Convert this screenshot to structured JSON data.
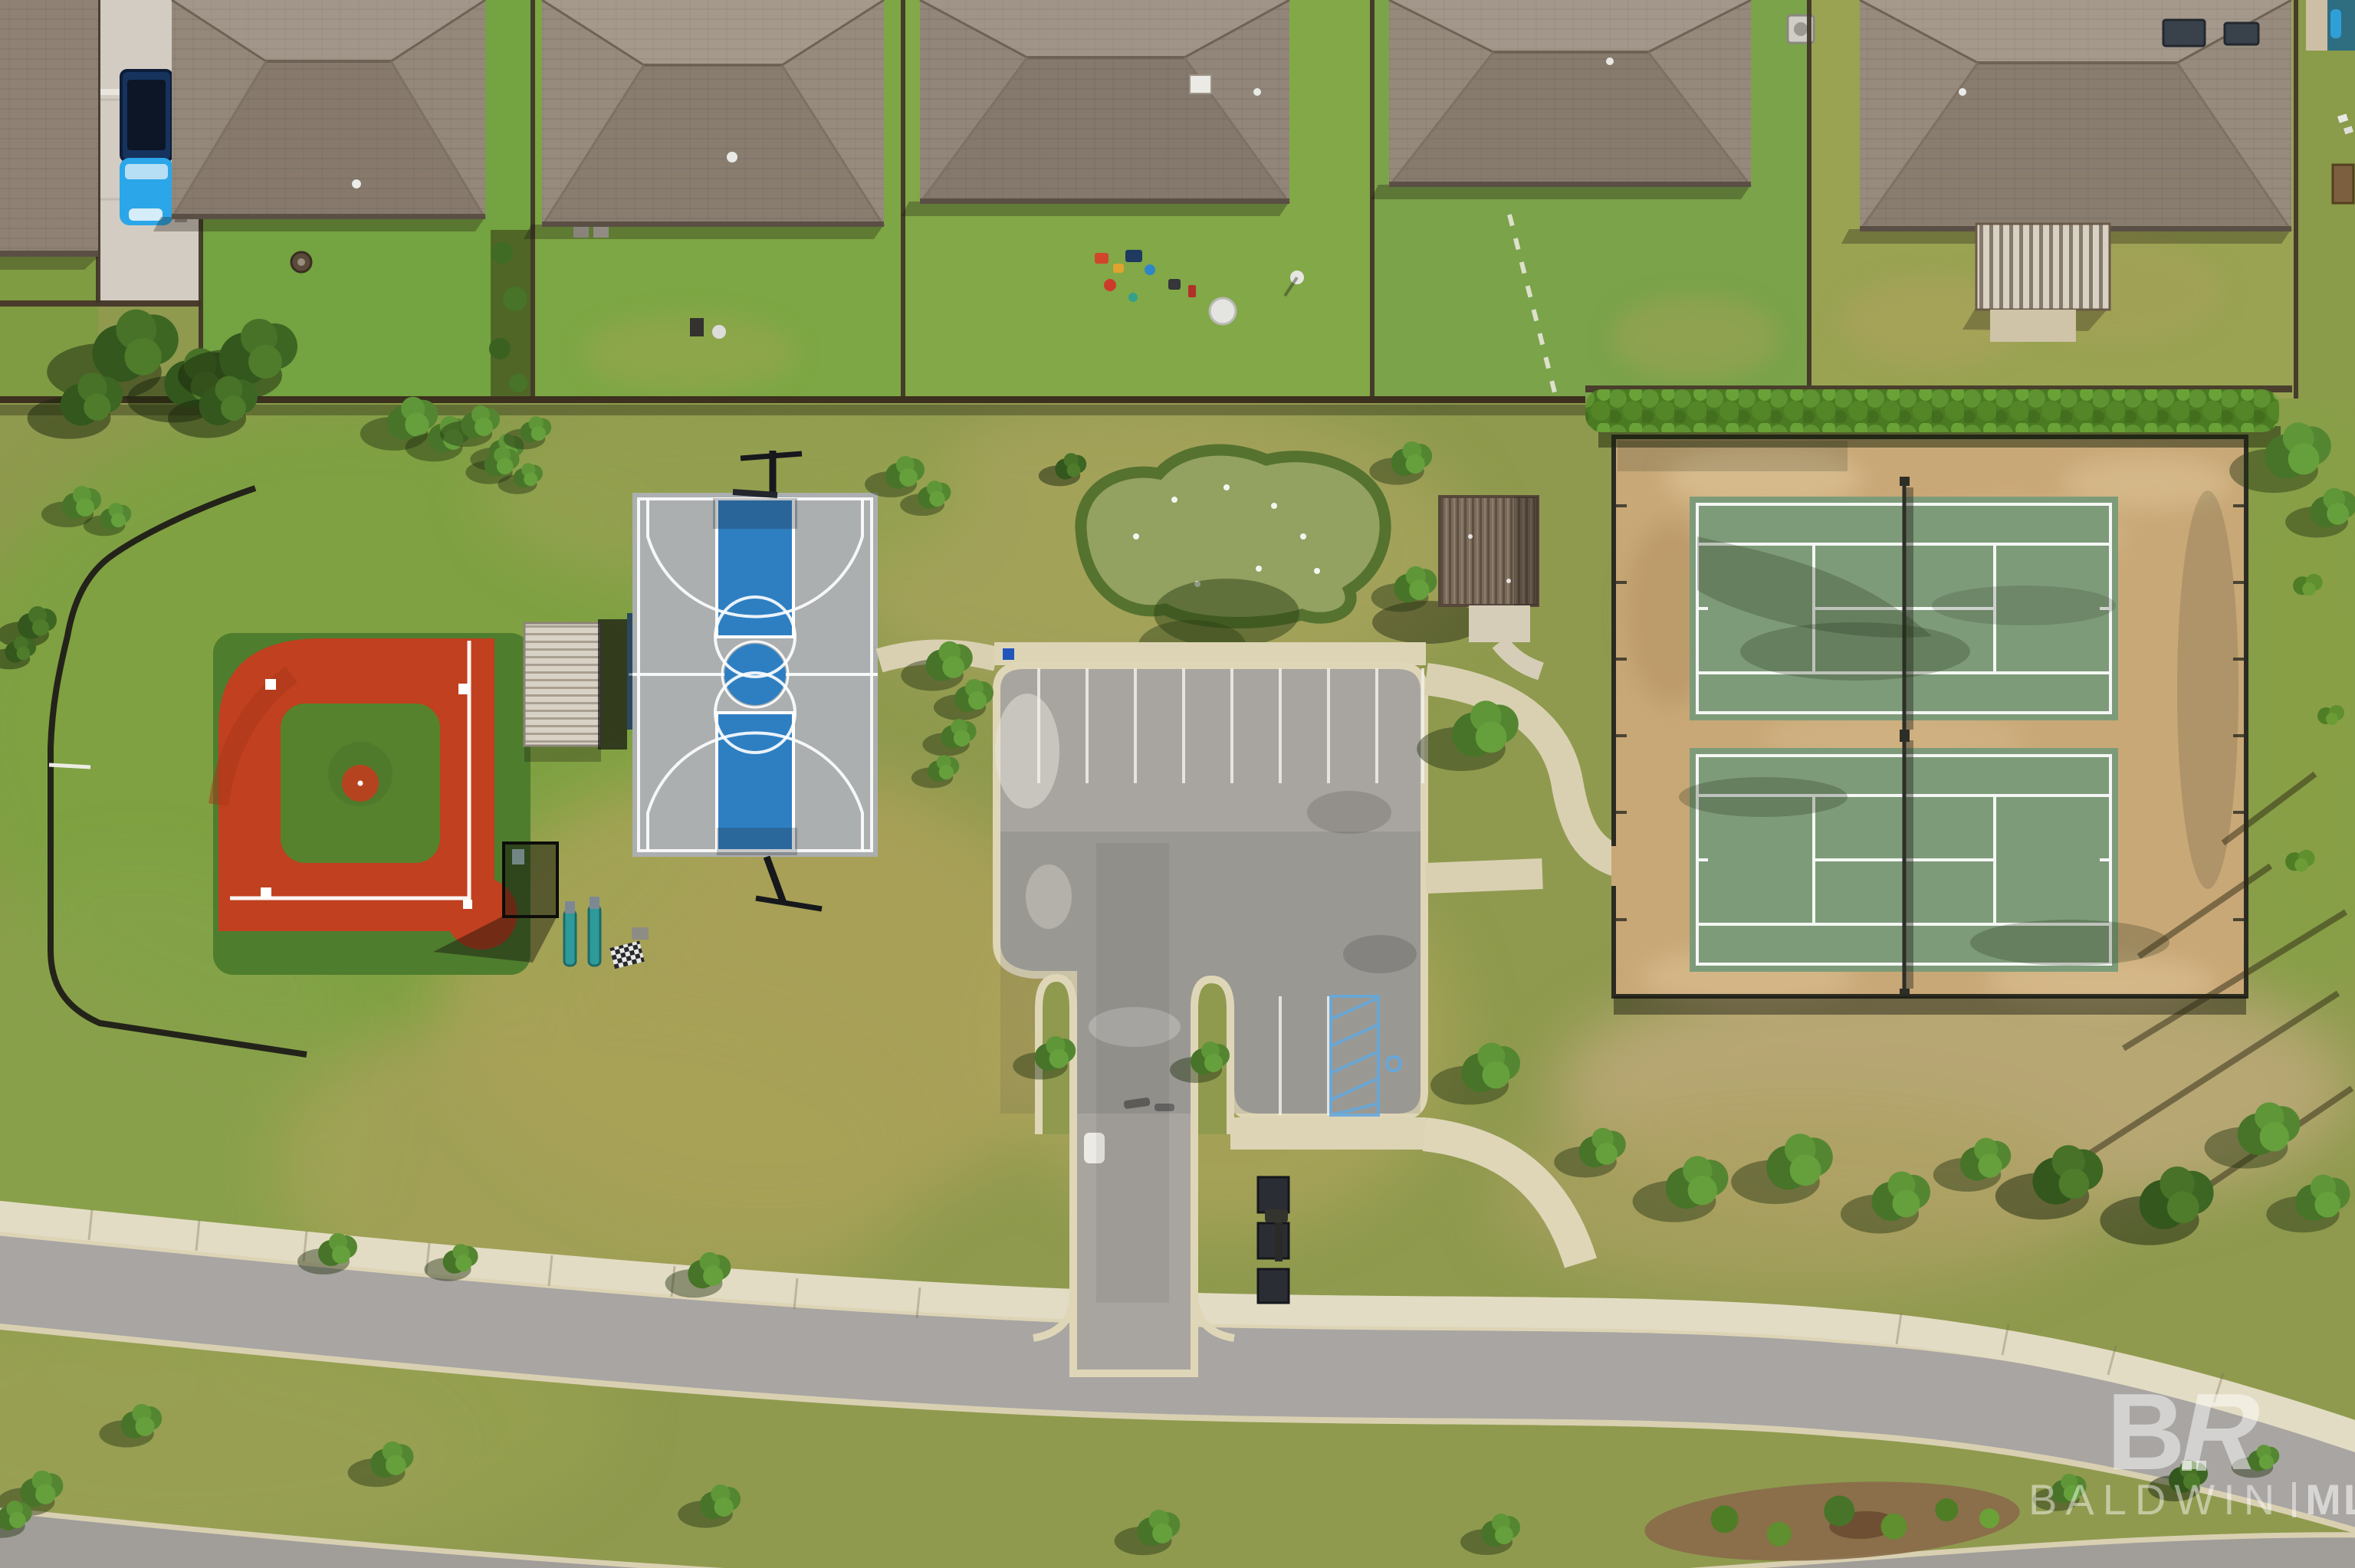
{
  "watermark": {
    "logo_b": "B",
    "logo_r": "R",
    "baldwin": "BALDWIN",
    "divider": "",
    "mls": "MLS"
  },
  "palette": {
    "grass_green": "#7fa03f",
    "grass_olive": "#8f9a4e",
    "grass_dry": "#b6a75f",
    "sand_tan": "#c9a877",
    "roof_brown": "#94887a",
    "asphalt_gray": "#a8a5a0",
    "concrete_cream": "#ddd4b6",
    "baseball_red": "#c0401f",
    "infield_green": "#56822e",
    "court_gray": "#b7babb",
    "court_blue": "#2e7fc2",
    "tennis_green": "#7e9b79",
    "canopy_navy": "#24415f",
    "truck_blue": "#2ba6e9",
    "fence_dark": "#3c301f"
  },
  "features": {
    "top": "row of houses with backyards",
    "left": "baseball field with batting cage",
    "center_left": "basketball court with shade deck",
    "center": "putting green, pavilion and parking lot",
    "right": "two fenced tennis courts",
    "bottom": "boulevard with landscaped median"
  }
}
